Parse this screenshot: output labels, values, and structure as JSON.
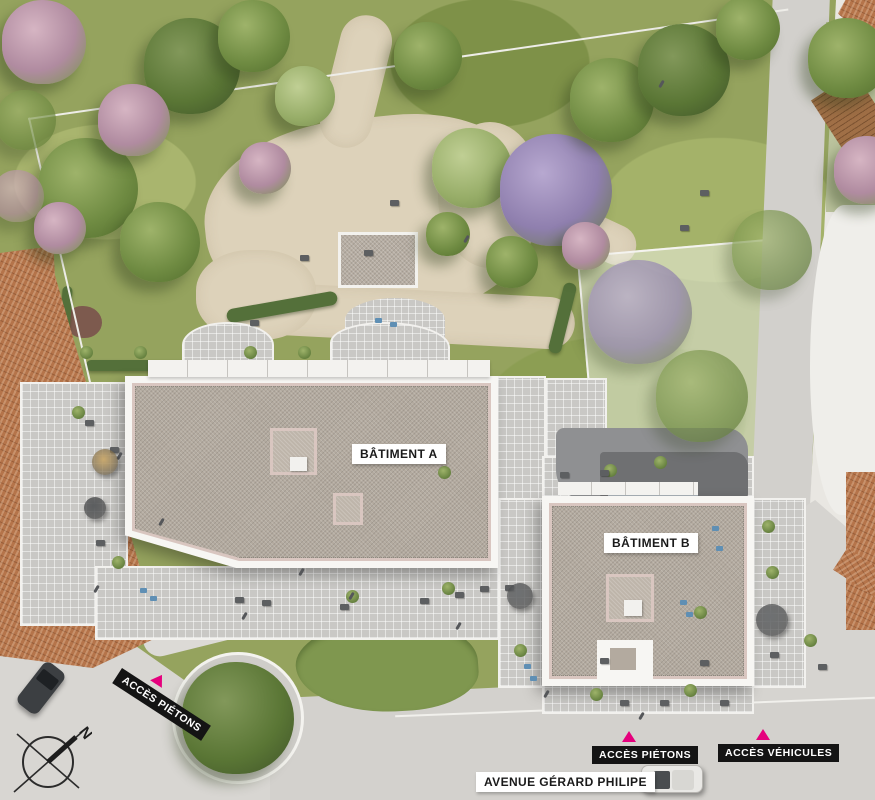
{
  "plan": {
    "type": "architectural-site-plan",
    "buildings": [
      {
        "id": "A",
        "label": "BÂTIMENT A"
      },
      {
        "id": "B",
        "label": "BÂTIMENT B"
      }
    ],
    "access_points": [
      {
        "label": "ACCÈS PIÉTONS",
        "position": "west",
        "marker": "pink-triangle"
      },
      {
        "label": "ACCÈS PIÉTONS",
        "position": "south",
        "marker": "pink-triangle"
      },
      {
        "label": "ACCÈS VÉHICULES",
        "position": "south-east",
        "marker": "pink-triangle"
      }
    ],
    "street_name": "AVENUE GÉRARD PHILIPE",
    "compass": {
      "north_letter": "N"
    }
  },
  "labels": {
    "building_a": "BÂTIMENT A",
    "building_b": "BÂTIMENT B",
    "access_pedestrian_west": "ACCÈS PIÉTONS",
    "access_pedestrian_south": "ACCÈS PIÉTONS",
    "access_vehicles": "ACCÈS VÉHICULES",
    "street": "AVENUE GÉRARD PHILIPE"
  },
  "colors": {
    "accent_pink": "#E5007D",
    "label_black_bg": "#141414",
    "label_white_bg": "#FFFFFF",
    "grass": "#95A35E",
    "sand_path": "#DDD2BA",
    "gravel_roof": "#B3AA9F",
    "roof_trim_pink": "#D9C6C0",
    "terrace_tile": "#C9C8C5",
    "street_gray": "#D3D1CD",
    "terracotta": "#B5744A",
    "hedge_green": "#54703A"
  },
  "scene": {
    "trees": [
      {
        "x": 88,
        "y": 188,
        "r": 50,
        "t": "g"
      },
      {
        "x": 192,
        "y": 66,
        "r": 48,
        "t": "d"
      },
      {
        "x": 134,
        "y": 120,
        "r": 36,
        "t": "p"
      },
      {
        "x": 44,
        "y": 42,
        "r": 42,
        "t": "p"
      },
      {
        "x": 254,
        "y": 36,
        "r": 36,
        "t": "g"
      },
      {
        "x": 160,
        "y": 242,
        "r": 40,
        "t": "g"
      },
      {
        "x": 428,
        "y": 56,
        "r": 34,
        "t": "g"
      },
      {
        "x": 472,
        "y": 168,
        "r": 40,
        "t": "l"
      },
      {
        "x": 556,
        "y": 190,
        "r": 56,
        "t": "v"
      },
      {
        "x": 612,
        "y": 100,
        "r": 42,
        "t": "g"
      },
      {
        "x": 684,
        "y": 70,
        "r": 46,
        "t": "d"
      },
      {
        "x": 748,
        "y": 28,
        "r": 32,
        "t": "g"
      },
      {
        "x": 848,
        "y": 58,
        "r": 40,
        "t": "g"
      },
      {
        "x": 868,
        "y": 170,
        "r": 34,
        "t": "p"
      },
      {
        "x": 640,
        "y": 312,
        "r": 52,
        "t": "v",
        "faded": true
      },
      {
        "x": 702,
        "y": 396,
        "r": 46,
        "t": "g",
        "faded": true
      },
      {
        "x": 772,
        "y": 250,
        "r": 40,
        "t": "g",
        "faded": true
      },
      {
        "x": 238,
        "y": 718,
        "r": 56,
        "t": "d"
      },
      {
        "x": 60,
        "y": 228,
        "r": 26,
        "t": "p"
      },
      {
        "x": 305,
        "y": 96,
        "r": 30,
        "t": "l"
      },
      {
        "x": 586,
        "y": 246,
        "r": 24,
        "t": "p"
      },
      {
        "x": 448,
        "y": 234,
        "r": 22,
        "t": "g"
      },
      {
        "x": 512,
        "y": 262,
        "r": 26,
        "t": "g"
      },
      {
        "x": 26,
        "y": 120,
        "r": 30,
        "t": "g",
        "faded": true
      },
      {
        "x": 18,
        "y": 196,
        "r": 26,
        "t": "p",
        "faded": true
      },
      {
        "x": 265,
        "y": 168,
        "r": 26,
        "t": "p"
      }
    ],
    "shrubs": [
      [
        78,
        412
      ],
      [
        118,
        562
      ],
      [
        352,
        596
      ],
      [
        448,
        588
      ],
      [
        520,
        650
      ],
      [
        700,
        612
      ],
      [
        768,
        526
      ],
      [
        772,
        572
      ],
      [
        610,
        470
      ],
      [
        660,
        462
      ],
      [
        596,
        694
      ],
      [
        86,
        352
      ],
      [
        140,
        352
      ],
      [
        250,
        352
      ],
      [
        304,
        352
      ],
      [
        690,
        690
      ],
      [
        810,
        640
      ],
      [
        444,
        472
      ]
    ],
    "furniture": [
      [
        110,
        447
      ],
      [
        85,
        420
      ],
      [
        235,
        597
      ],
      [
        262,
        600
      ],
      [
        340,
        604
      ],
      [
        420,
        598
      ],
      [
        455,
        592
      ],
      [
        505,
        585
      ],
      [
        600,
        658
      ],
      [
        620,
        700
      ],
      [
        660,
        700
      ],
      [
        700,
        660
      ],
      [
        770,
        652
      ],
      [
        818,
        664
      ],
      [
        560,
        472
      ],
      [
        600,
        470
      ],
      [
        96,
        540
      ],
      [
        480,
        586
      ],
      [
        720,
        700
      ],
      [
        364,
        250
      ],
      [
        300,
        255
      ],
      [
        390,
        200
      ],
      [
        680,
        225
      ],
      [
        700,
        190
      ],
      [
        250,
        320
      ]
    ],
    "blues": [
      [
        140,
        588
      ],
      [
        150,
        596
      ],
      [
        680,
        600
      ],
      [
        686,
        612
      ],
      [
        524,
        664
      ],
      [
        530,
        676
      ],
      [
        375,
        318
      ],
      [
        390,
        322
      ],
      [
        712,
        526
      ],
      [
        716,
        546
      ]
    ],
    "people": [
      [
        350,
        592
      ],
      [
        300,
        568
      ],
      [
        457,
        622
      ],
      [
        640,
        712
      ],
      [
        545,
        690
      ],
      [
        95,
        585
      ],
      [
        243,
        612
      ],
      [
        118,
        452
      ],
      [
        160,
        518
      ],
      [
        660,
        80
      ],
      [
        465,
        235
      ]
    ],
    "umbrellas": [
      {
        "x": 105,
        "y": 462,
        "r": 13,
        "c": "#c9a96e"
      },
      {
        "x": 520,
        "y": 596,
        "r": 13,
        "c": "#6e7072"
      },
      {
        "x": 772,
        "y": 620,
        "r": 16,
        "c": "#6e7072"
      },
      {
        "x": 95,
        "y": 508,
        "r": 11,
        "c": "#5b5d5f"
      }
    ]
  }
}
